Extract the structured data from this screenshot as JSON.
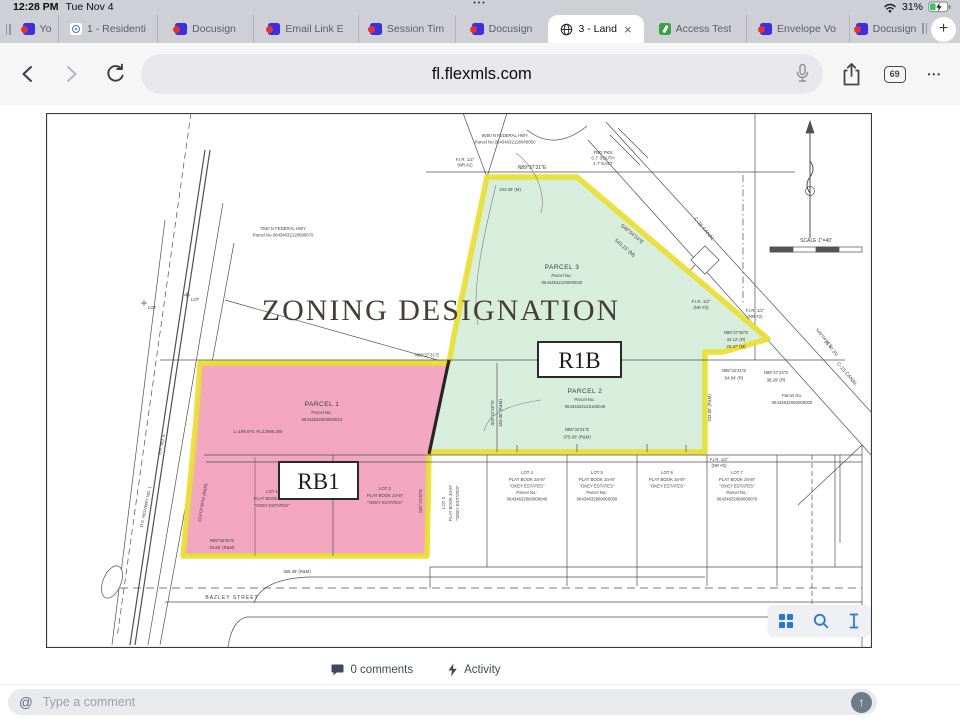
{
  "status_bar": {
    "time": "12:28 PM",
    "date": "Tue Nov 4",
    "battery_percent": "31%"
  },
  "tab_bar": {
    "tabs": [
      {
        "label": "Yo"
      },
      {
        "label": "1 - Residenti"
      },
      {
        "label": "Docusign"
      },
      {
        "label": "Email Link E"
      },
      {
        "label": "Session Tim"
      },
      {
        "label": "Docusign"
      },
      {
        "label": "3 - Land",
        "active": true
      },
      {
        "label": "Access Test"
      },
      {
        "label": "Envelope Vo"
      },
      {
        "label": "Docusign"
      }
    ],
    "new_tab_label": "+",
    "close_label": "×"
  },
  "nav": {
    "url": "fl.flexmls.com",
    "tab_count": "69"
  },
  "viewer_toolbar": {
    "icons": [
      "grid-icon",
      "search-icon",
      "text-cursor-icon"
    ]
  },
  "footer": {
    "comments_label": "0 comments",
    "activity_label": "Activity"
  },
  "comment_bar": {
    "placeholder": "Type a comment",
    "send_glyph": "↑",
    "at_glyph": "@"
  },
  "map": {
    "heading": "ZONING DESIGNATION",
    "zones": {
      "green_label": "R1B",
      "pink_label": "RB1"
    },
    "colors": {
      "green_zone": "#d7eedd",
      "pink_zone": "#f3a6c0",
      "highlight_yellow": "#e9df2e"
    },
    "labels": {
      "hwy8000_1": "8000 N FEDERAL HWY",
      "hwy8000_2": "Parcel No.06434632120040050",
      "hwy7940_1": "7940 N FEDERAL HWY",
      "hwy7940_2": "Parcel No.06434632120090070",
      "fir_nw_1": "F.I.R. 1/2\"",
      "fir_nw_2": "(NR #2)",
      "brg_top": "N89°37'31\"E",
      "dim_top": "103.38' (M)",
      "fnd_1": "FND PKN",
      "fnd_2": "0.7' SOUTH",
      "fnd_3": "1.7' EAST",
      "parcel3_1": "PARCEL 3",
      "parcel3_2": "Parcel No.:",
      "parcel3_3": "06434632120000040",
      "brg_diag_1": "S49°04'24\"E",
      "brg_diag_2": "543.15' (M)",
      "canal_upper": "C-15 CANAL",
      "canal_lower": "C-15 CANAL",
      "brg_canal_1": "S49°04'24\"E",
      "brg_canal_2": "35.40' (R)",
      "fir_e1_1": "F.I.R. 1/2\"",
      "fir_e1_2": "(NR #2)",
      "fir_e2_1": "F.I.R. 1/2\"",
      "fir_e2_2": "(NR #2)",
      "brg_e1_1": "N89°27'36\"E",
      "brg_e1_2": "34.12' (R)",
      "brg_e1_3": "29.47' (M)",
      "brg_e2_1": "N89°32'31\"E",
      "brg_e2_2": "54.84' (R)",
      "brg_e3_1": "N89°27'24\"E",
      "brg_e3_2": "38.29' (R)",
      "parcel_e_1": "Parcel No.",
      "parcel_e_2": "06434632060000000",
      "scale": "SCALE 1\"=40'",
      "brg_mid": "N89°37'31\"E",
      "parcel2_1": "PARCEL 2",
      "parcel2_2": "Parcel No.:",
      "parcel2_3": "06434632125160040",
      "brg_p2_1": "N89°32'31\"E",
      "brg_p2_2": "375.00' (R&M)",
      "brg_w_1": "S02°22'26\"W",
      "brg_w_2": "103.00' (R&M)",
      "dim_er": "103.00' (R&M)",
      "parcel1_1": "PARCEL 1",
      "parcel1_2": "Parcel No.:",
      "parcel1_3": "06434632060050010",
      "curve": "L=198.670, R=22996.300",
      "lot1_1": "LOT 1",
      "lot1_2": "PLAT BOOK 34-97",
      "lot1_3": "\"OKEY ESTATES\"",
      "lot2_1": "LOT 2",
      "lot2_2": "PLAT BOOK 34-97",
      "lot2_3": "\"OKEY ESTATES\"",
      "brg_sw_1": "N09°56'26\"E",
      "brg_sw_2": "23.82' (R&M)",
      "us1": "U.S. HIGHWAY NO. 1",
      "sr5": "S.R. NO. 5",
      "brg_wl": "S13°02'39\"W (R&M)",
      "brg_lot3": "S02°23'26\"E",
      "fir_lots_1": "F.I.R. 1/2\"",
      "fir_lots_2": "(NR #2)",
      "dim_bazley": "369.38' (R&M)",
      "bazley": "BAZLEY STREET",
      "lot_nw": "LOT"
    },
    "lots": {
      "lot3": [
        "LOT 3",
        "PLAT BOOK 34-97",
        "\"OKEY ESTATES\""
      ],
      "lot4": [
        "LOT 4",
        "PLAT BOOK 34-97",
        "\"OKEY ESTATES\"",
        "Parcel No.:",
        "06434632080000040"
      ],
      "lot5": [
        "LOT 5",
        "PLAT BOOK 34-97",
        "\"OKEY ESTATES\"",
        "Parcel No.:",
        "06434632080000050"
      ],
      "lot6": [
        "LOT 6",
        "PLAT BOOK 34-97",
        "\"OKEY ESTATES\""
      ],
      "lot7": [
        "LOT 7",
        "PLAT BOOK 34-97",
        "\"OKEY ESTATES\"",
        "Parcel No.:",
        "06434632080000070"
      ]
    }
  }
}
